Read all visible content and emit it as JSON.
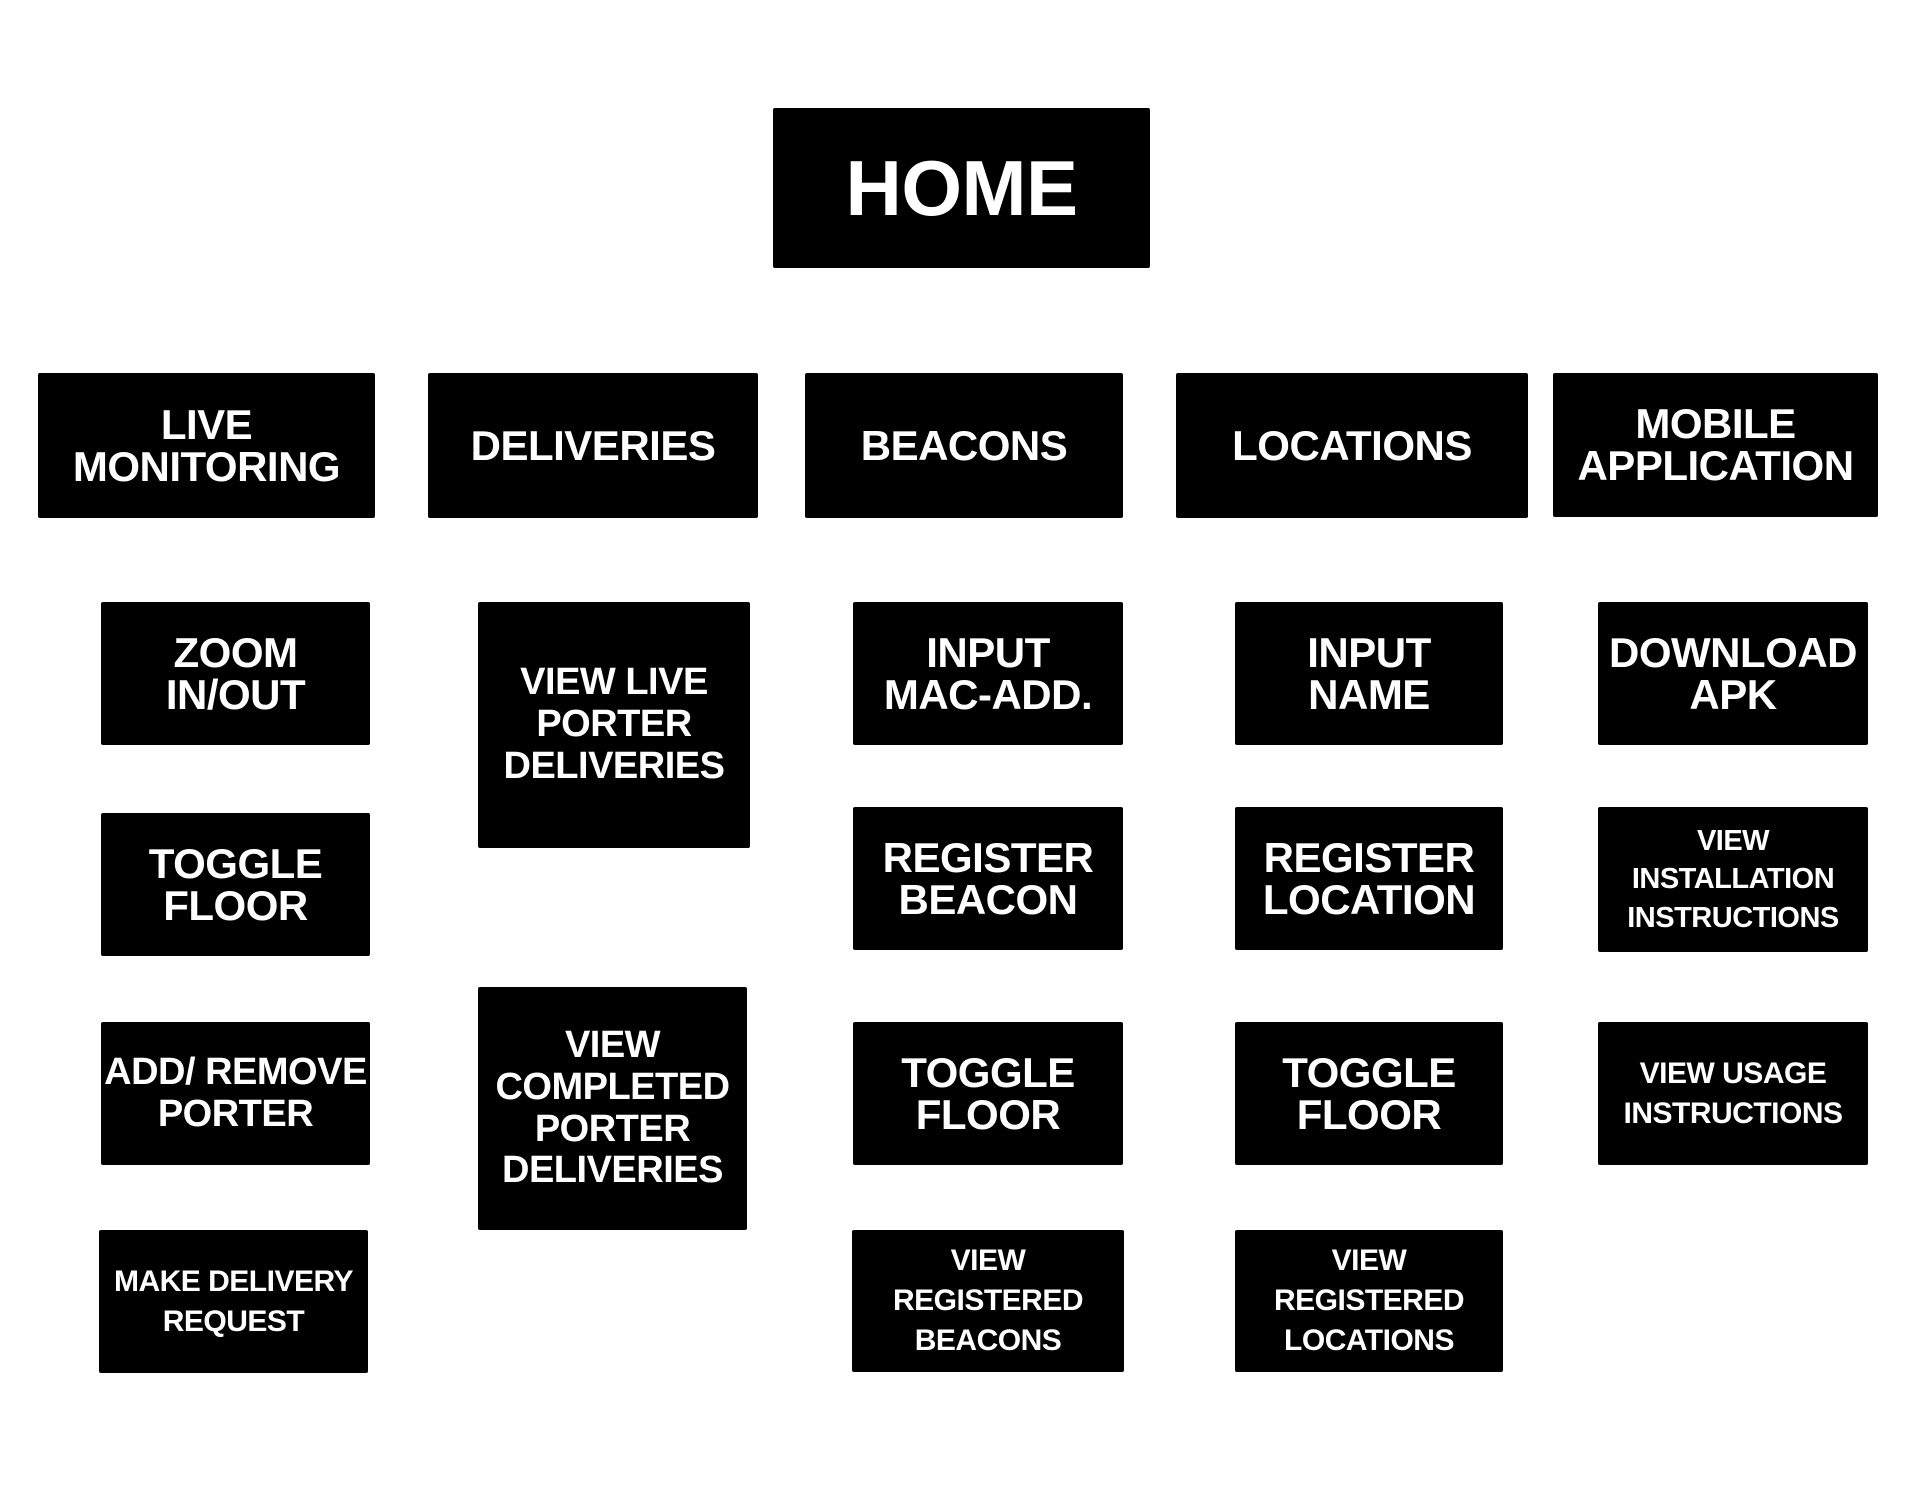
{
  "root": {
    "label": "HOME"
  },
  "columns": [
    {
      "header": {
        "label": "LIVE\nMONITORING"
      },
      "children": [
        {
          "label": "ZOOM\nIN/OUT"
        },
        {
          "label": "TOGGLE\nFLOOR"
        },
        {
          "label": "ADD/ REMOVE\nPORTER"
        },
        {
          "label": "MAKE DELIVERY\nREQUEST"
        }
      ]
    },
    {
      "header": {
        "label": "DELIVERIES"
      },
      "children": [
        {
          "label": "VIEW LIVE\nPORTER\nDELIVERIES"
        },
        {
          "label": "VIEW\nCOMPLETED\nPORTER\nDELIVERIES"
        }
      ]
    },
    {
      "header": {
        "label": "BEACONS"
      },
      "children": [
        {
          "label": "INPUT\nMAC-ADD."
        },
        {
          "label": "REGISTER\nBEACON"
        },
        {
          "label": "TOGGLE\nFLOOR"
        },
        {
          "label": "VIEW\nREGISTERED\nBEACONS"
        }
      ]
    },
    {
      "header": {
        "label": "LOCATIONS"
      },
      "children": [
        {
          "label": "INPUT\nNAME"
        },
        {
          "label": "REGISTER\nLOCATION"
        },
        {
          "label": "TOGGLE\nFLOOR"
        },
        {
          "label": "VIEW\nREGISTERED\nLOCATIONS"
        }
      ]
    },
    {
      "header": {
        "label": "MOBILE\nAPPLICATION"
      },
      "children": [
        {
          "label": "DOWNLOAD\nAPK"
        },
        {
          "label": "VIEW\nINSTALLATION\nINSTRUCTIONS"
        },
        {
          "label": "VIEW USAGE\nINSTRUCTIONS"
        }
      ]
    }
  ],
  "colors": {
    "box_bg": "#000000",
    "box_text": "#ffffff",
    "page_bg": "#ffffff"
  }
}
